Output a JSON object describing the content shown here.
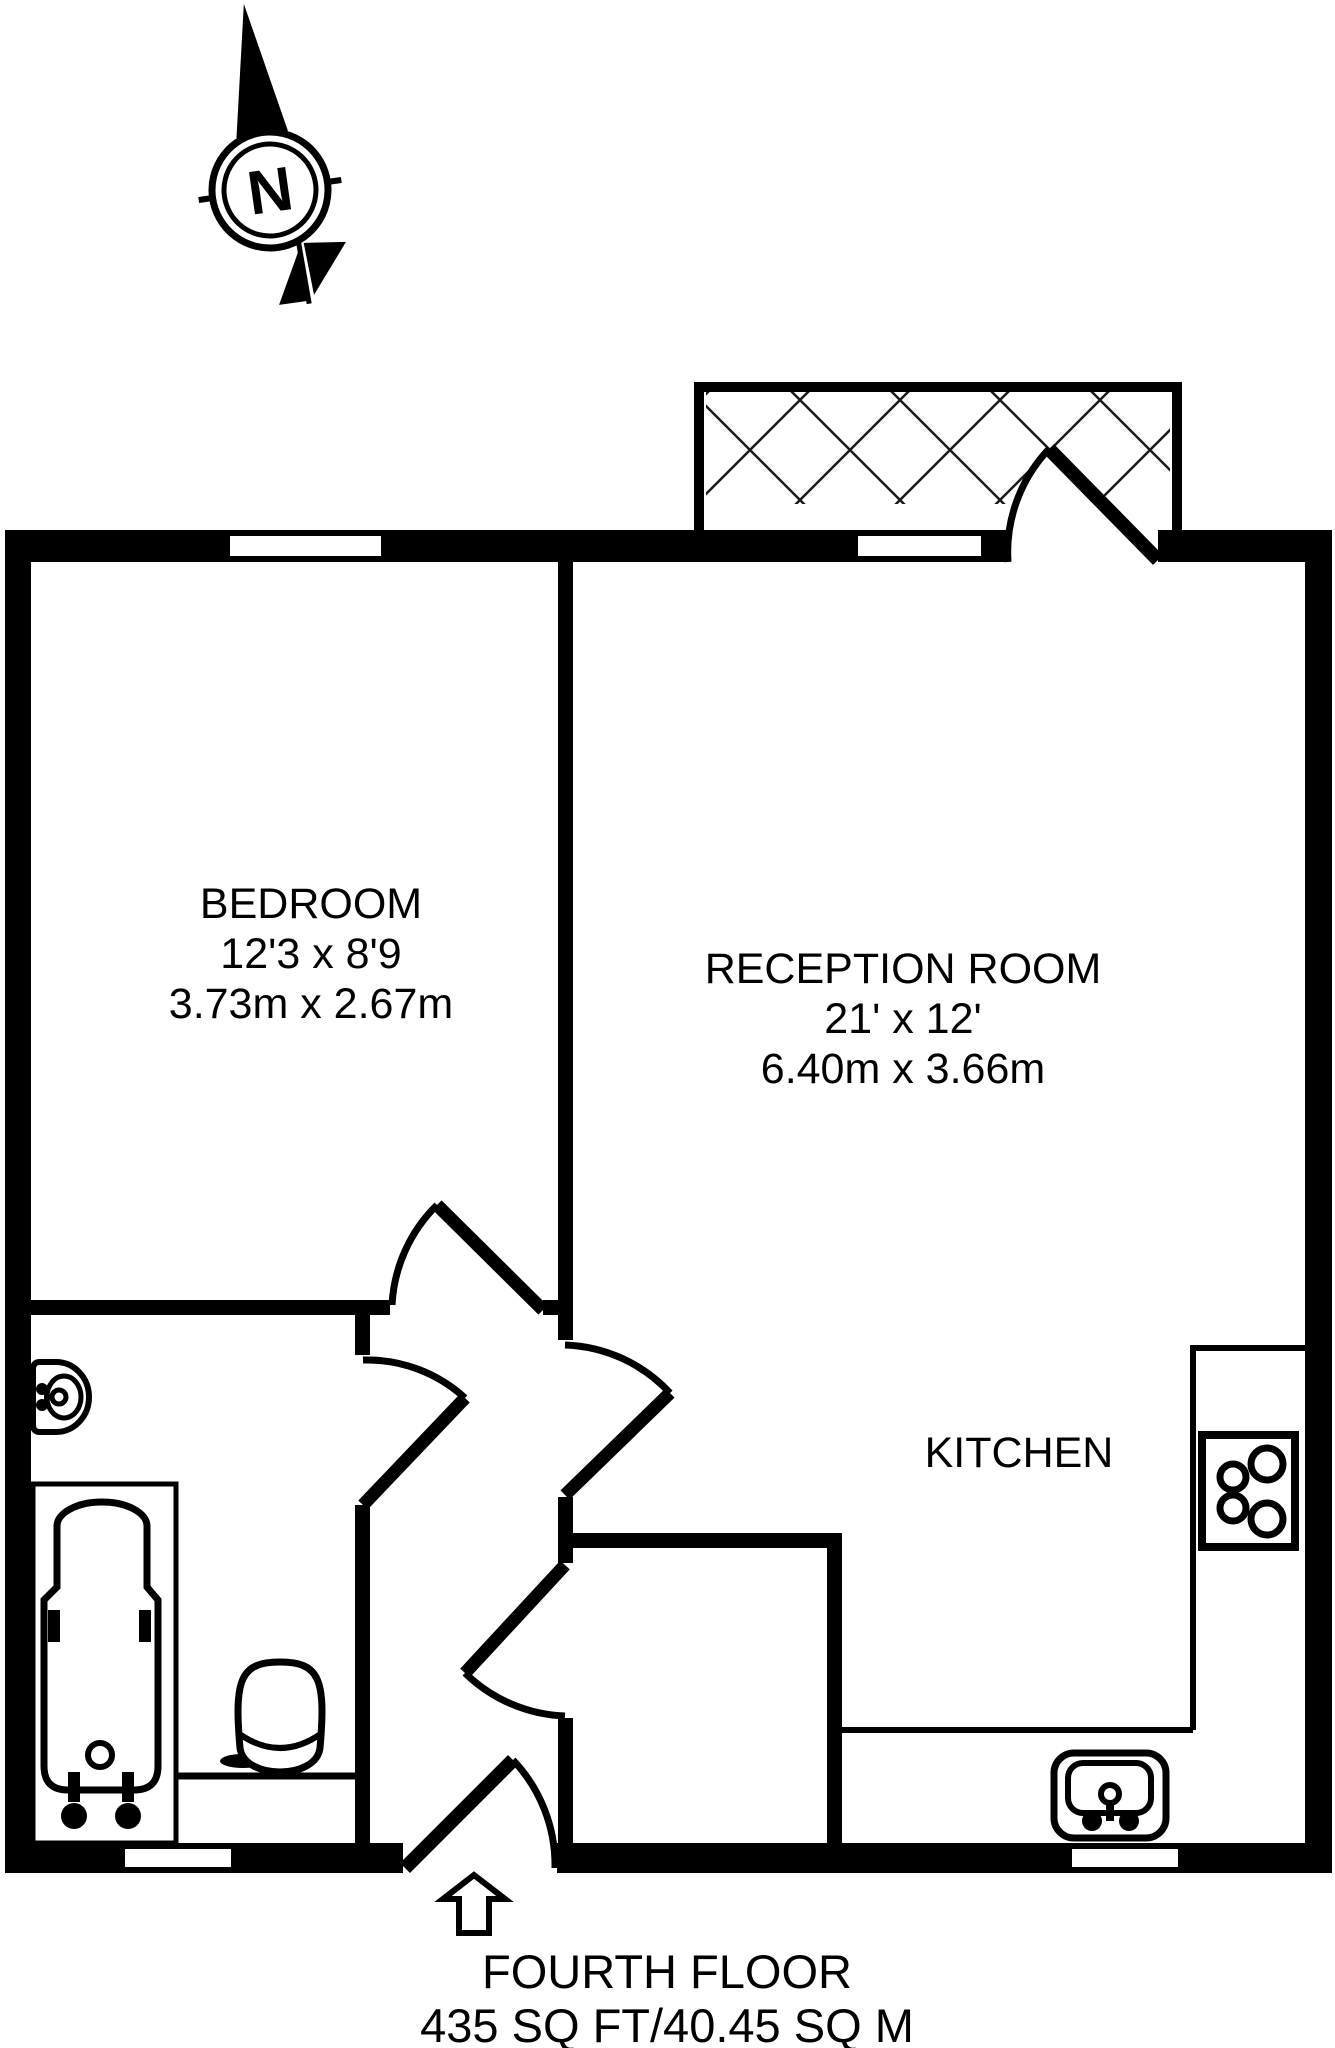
{
  "compass": {
    "letter": "N"
  },
  "rooms": {
    "bedroom": {
      "name": "BEDROOM",
      "imperial": "12'3 x 8'9",
      "metric": "3.73m x 2.67m"
    },
    "reception": {
      "name": "RECEPTION ROOM",
      "imperial": "21' x 12'",
      "metric": "6.40m x 3.66m"
    },
    "kitchen": {
      "name": "KITCHEN"
    }
  },
  "footer": {
    "floor": "FOURTH FLOOR",
    "area": "435 SQ FT/40.45 SQ M"
  },
  "colors": {
    "line": "#000000",
    "background": "#ffffff"
  }
}
